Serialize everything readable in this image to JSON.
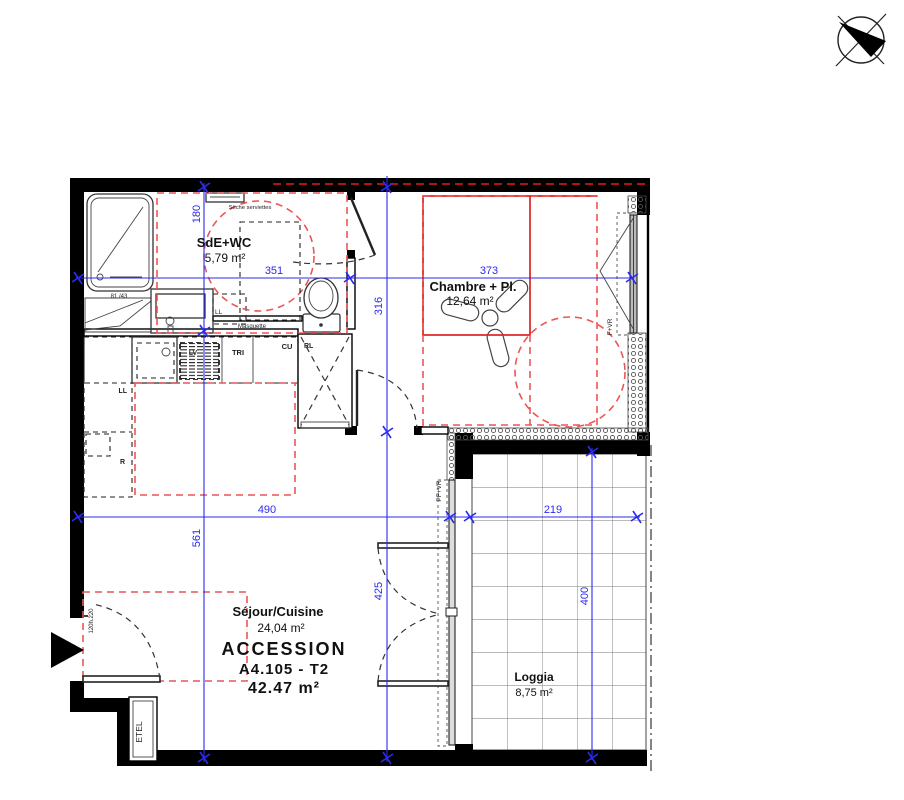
{
  "rooms": {
    "sde": {
      "name": "SdE+WC",
      "area": "5,79 m²"
    },
    "chambre": {
      "name": "Chambre + Pl.",
      "area": "12,64 m²"
    },
    "sejour": {
      "name": "Séjour/Cuisine",
      "area": "24,04 m²"
    },
    "loggia": {
      "name": "Loggia",
      "area": "8,75 m²"
    }
  },
  "title_block": {
    "program": "ACCESSION",
    "lot": "A4.105 - T2",
    "total_area": "42.47 m²"
  },
  "dimensions": {
    "sde_width": "351",
    "chambre_width": "373",
    "sde_depth": "180",
    "sejour_depth": "561",
    "chambre_depth": "316",
    "bay_span": "425",
    "sejour_width": "490",
    "loggia_width": "219",
    "loggia_depth": "400"
  },
  "annotations": {
    "towel_radiator": "Sèche serviettes",
    "shower_note": "81 /43",
    "masquette": "Masquette",
    "washer_sde": "LL",
    "washer_kitchen": "LL",
    "dishwasher": "LV",
    "sorting": "TRI",
    "cooking": "CU",
    "duct": "RL",
    "fridge": "R",
    "utility_closet": "ETEL",
    "entry_door_size": "120h.220",
    "bay_window": "PF+VR",
    "bedroom_window": "F+VR"
  },
  "colors": {
    "dimension_blue": "#2b2bf0",
    "zone_red": "#ee5555",
    "solid_red": "#dd2222",
    "accent_dark_red": "#b11212",
    "wall_black": "#000000"
  }
}
